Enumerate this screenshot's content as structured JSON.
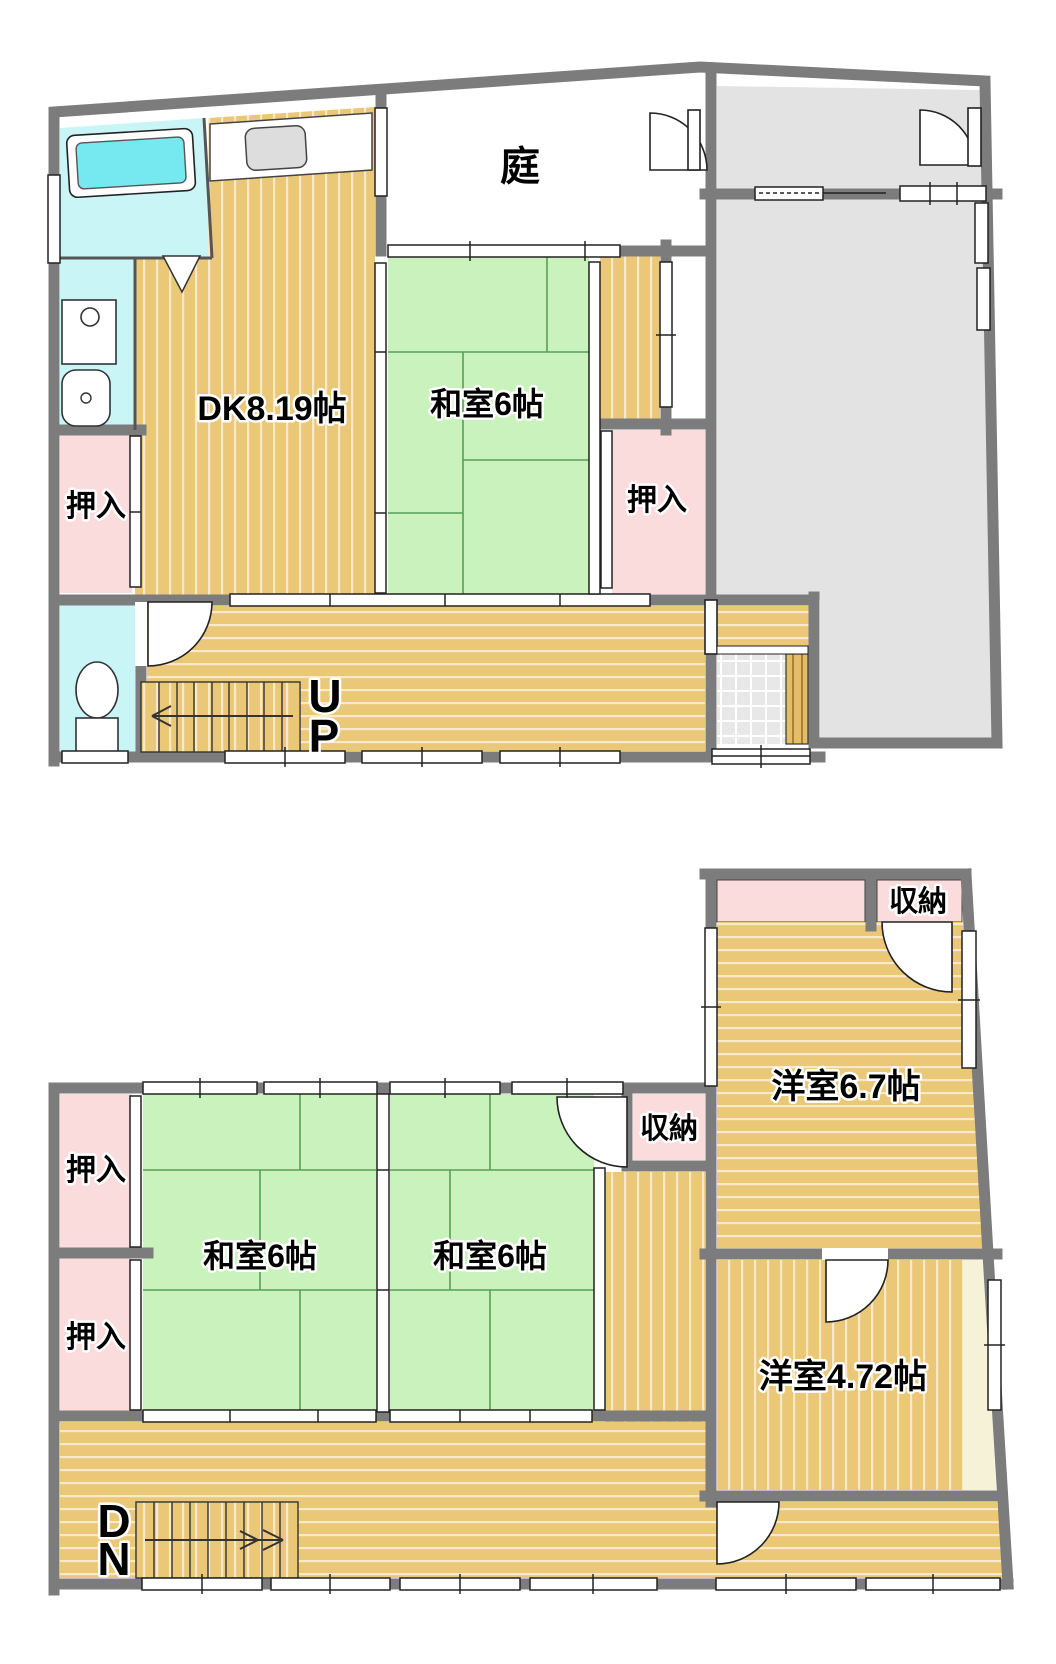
{
  "title": "2-story Japanese house floor plan",
  "palette": {
    "wall": "#7c7c7c",
    "wood": "#eac877",
    "tatami": "#c9f2bc",
    "closet_pink": "#fbdcdc",
    "bath_cyan": "#c9f5f7",
    "tub_cyan": "#76e9f0",
    "earth_gray": "#e3e3e3",
    "tile_gray": "#e8e8e8",
    "cream": "#f6f2d8"
  },
  "floor1": {
    "labels": {
      "dk": "DK8.19帖",
      "washitsu": "和室6帖",
      "garden": "庭",
      "closet_left": "押入",
      "closet_right": "押入",
      "stairs_u": "U",
      "stairs_p": "P"
    }
  },
  "floor2": {
    "labels": {
      "closet_upper": "押入",
      "closet_lower": "押入",
      "washitsu_left": "和室6帖",
      "washitsu_right": "和室6帖",
      "storage_mid": "収納",
      "storage_top": "収納",
      "western_67": "洋室6.7帖",
      "western_472": "洋室4.72帖",
      "stairs_d": "D",
      "stairs_n": "N"
    }
  }
}
